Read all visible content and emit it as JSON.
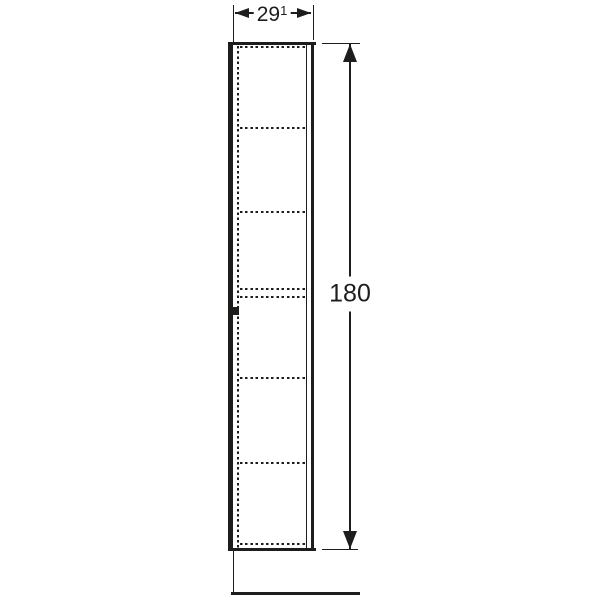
{
  "drawing": {
    "type": "furniture-dimension-drawing",
    "subject": "tall-cabinet-elevation",
    "background_color": "#ffffff",
    "line_color": "#1d1d1b",
    "dimensions": {
      "width": {
        "value": "29",
        "footnote": "1"
      },
      "height": {
        "value": "180"
      }
    },
    "shelf_dashed_lines_y": [
      46,
      127,
      211,
      288,
      295.5,
      377,
      462,
      543
    ]
  }
}
